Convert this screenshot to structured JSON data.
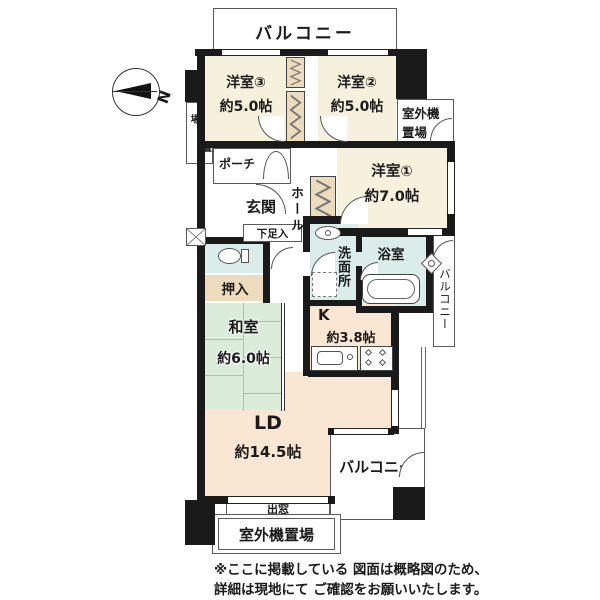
{
  "labels": {
    "balcony_top": "バルコニー",
    "room3": {
      "name": "洋室③",
      "size": "約5.0帖"
    },
    "room2": {
      "name": "洋室②",
      "size": "約5.0帖"
    },
    "room1": {
      "name": "洋室①",
      "size": "約7.0帖"
    },
    "outdoor_unit_left": "室外機置場",
    "outdoor_unit_right": {
      "line1": "室外機",
      "line2": "置場"
    },
    "porch": "ポーチ",
    "entrance": "玄関",
    "shoe_box": "下足入",
    "hall": "ホール",
    "washroom": "洗面所",
    "bath": "浴室",
    "balcony_right": "バルコニー",
    "oshiire": "押入",
    "washitsu": {
      "name": "和室",
      "size": "約6.0帖"
    },
    "kitchen": {
      "name": "K",
      "size": "約3.8帖"
    },
    "living": {
      "name": "LD",
      "size": "約14.5帖"
    },
    "balcony_bottom": "バルコニー",
    "bay_window": "出窓",
    "outdoor_unit_bottom": "室外機置場",
    "compass_n": "N",
    "note": {
      "line1": "※ここに掲載している 図面は概略図のため、",
      "line2": "詳細は現地にて ご確認をお願いいたします。"
    }
  },
  "colors": {
    "wall": "#1a1a1a",
    "western_room": "#f6f1dd",
    "living": "#f9e6d3",
    "tatami": "#dcecdb",
    "wet_area": "#daedea",
    "storage": "#ecdcbb",
    "text": "#1b1b1b"
  }
}
